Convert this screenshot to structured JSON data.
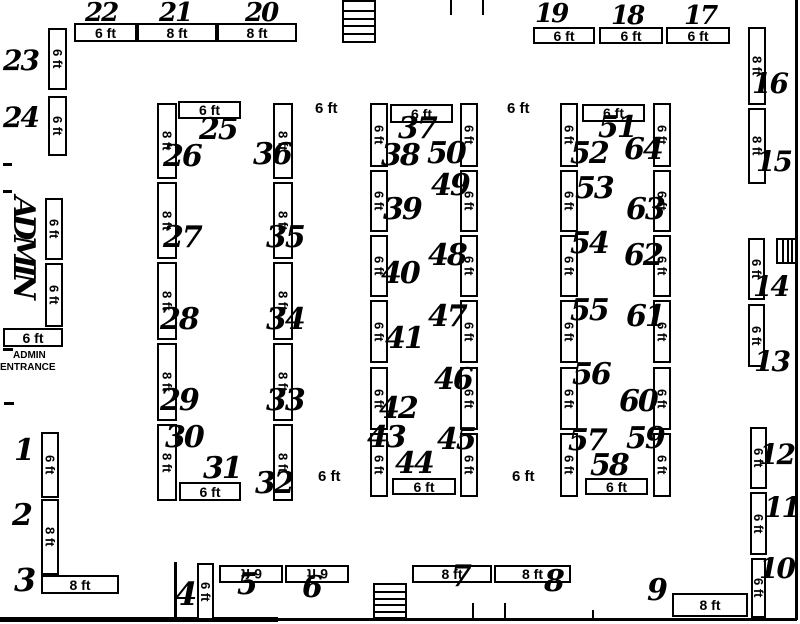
{
  "plan": {
    "colors": {
      "line": "#000000",
      "background": "#ffffff"
    },
    "admin": {
      "vertical_label": "ADMIN",
      "entrance_line1": "ADMIN",
      "entrance_line2": "ENTRANCE"
    },
    "floating_dims": [
      {
        "t": "6 ft",
        "x": 315,
        "y": 100
      },
      {
        "t": "6 ft",
        "x": 507,
        "y": 100
      },
      {
        "t": "6 ft",
        "x": 318,
        "y": 468
      },
      {
        "t": "6 ft",
        "x": 512,
        "y": 468
      }
    ],
    "dim_boxes": [
      {
        "t": "6 ft",
        "x": 74,
        "y": 23,
        "w": 63,
        "h": 19,
        "o": "h"
      },
      {
        "t": "8 ft",
        "x": 137,
        "y": 23,
        "w": 80,
        "h": 19,
        "o": "h"
      },
      {
        "t": "8 ft",
        "x": 217,
        "y": 23,
        "w": 80,
        "h": 19,
        "o": "h"
      },
      {
        "t": "6 ft",
        "x": 533,
        "y": 27,
        "w": 62,
        "h": 17,
        "o": "h"
      },
      {
        "t": "6 ft",
        "x": 599,
        "y": 27,
        "w": 64,
        "h": 17,
        "o": "h"
      },
      {
        "t": "6 ft",
        "x": 666,
        "y": 27,
        "w": 64,
        "h": 17,
        "o": "h"
      },
      {
        "t": "6 ft",
        "x": 48,
        "y": 28,
        "w": 19,
        "h": 62,
        "o": "v"
      },
      {
        "t": "6 ft",
        "x": 48,
        "y": 96,
        "w": 19,
        "h": 60,
        "o": "v"
      },
      {
        "t": "6 ft",
        "x": 45,
        "y": 198,
        "w": 18,
        "h": 62,
        "o": "v"
      },
      {
        "t": "6 ft",
        "x": 45,
        "y": 263,
        "w": 18,
        "h": 64,
        "o": "v"
      },
      {
        "t": "6 ft",
        "x": 3,
        "y": 328,
        "w": 60,
        "h": 19,
        "o": "h"
      },
      {
        "t": "6 ft",
        "x": 41,
        "y": 432,
        "w": 18,
        "h": 66,
        "o": "v"
      },
      {
        "t": "8 ft",
        "x": 41,
        "y": 499,
        "w": 18,
        "h": 76,
        "o": "v"
      },
      {
        "t": "8 ft",
        "x": 41,
        "y": 575,
        "w": 78,
        "h": 19,
        "o": "h"
      },
      {
        "t": "8 ft",
        "x": 748,
        "y": 27,
        "w": 18,
        "h": 78,
        "o": "v"
      },
      {
        "t": "8 ft",
        "x": 748,
        "y": 108,
        "w": 18,
        "h": 76,
        "o": "v"
      },
      {
        "t": "6 ft",
        "x": 748,
        "y": 238,
        "w": 17,
        "h": 62,
        "o": "v"
      },
      {
        "t": "6 ft",
        "x": 748,
        "y": 304,
        "w": 17,
        "h": 63,
        "o": "v"
      },
      {
        "t": "6 ft",
        "x": 750,
        "y": 427,
        "w": 17,
        "h": 62,
        "o": "v"
      },
      {
        "t": "6 ft",
        "x": 750,
        "y": 492,
        "w": 17,
        "h": 63,
        "o": "v"
      },
      {
        "t": "6 ft",
        "x": 751,
        "y": 558,
        "w": 15,
        "h": 60,
        "o": "v"
      },
      {
        "t": "8 ft",
        "x": 672,
        "y": 593,
        "w": 76,
        "h": 24,
        "o": "h"
      },
      {
        "t": "6 ft",
        "x": 197,
        "y": 563,
        "w": 17,
        "h": 57,
        "o": "v"
      },
      {
        "t": "6 ft",
        "x": 219,
        "y": 565,
        "w": 64,
        "h": 18,
        "o": "flip"
      },
      {
        "t": "6 ft",
        "x": 285,
        "y": 565,
        "w": 64,
        "h": 18,
        "o": "flip"
      },
      {
        "t": "8 ft",
        "x": 412,
        "y": 565,
        "w": 80,
        "h": 18,
        "o": "h"
      },
      {
        "t": "8 ft",
        "x": 494,
        "y": 565,
        "w": 77,
        "h": 18,
        "o": "h"
      },
      {
        "t": "6 ft",
        "x": 178,
        "y": 101,
        "w": 63,
        "h": 18,
        "o": "h"
      },
      {
        "t": "8 ft",
        "x": 157,
        "y": 103,
        "w": 20,
        "h": 76,
        "o": "v"
      },
      {
        "t": "8 ft",
        "x": 157,
        "y": 182,
        "w": 20,
        "h": 77,
        "o": "v"
      },
      {
        "t": "8 ft",
        "x": 157,
        "y": 262,
        "w": 20,
        "h": 78,
        "o": "v"
      },
      {
        "t": "8 ft",
        "x": 157,
        "y": 343,
        "w": 20,
        "h": 78,
        "o": "v"
      },
      {
        "t": "8 ft",
        "x": 157,
        "y": 424,
        "w": 20,
        "h": 77,
        "o": "v"
      },
      {
        "t": "8 ft",
        "x": 273,
        "y": 103,
        "w": 20,
        "h": 76,
        "o": "v"
      },
      {
        "t": "8 ft",
        "x": 273,
        "y": 182,
        "w": 20,
        "h": 77,
        "o": "v"
      },
      {
        "t": "8 ft",
        "x": 273,
        "y": 262,
        "w": 20,
        "h": 78,
        "o": "v"
      },
      {
        "t": "8 ft",
        "x": 273,
        "y": 343,
        "w": 20,
        "h": 78,
        "o": "v"
      },
      {
        "t": "8 ft",
        "x": 273,
        "y": 424,
        "w": 20,
        "h": 77,
        "o": "v"
      },
      {
        "t": "6 ft",
        "x": 179,
        "y": 482,
        "w": 62,
        "h": 19,
        "o": "h"
      },
      {
        "t": "6 ft",
        "x": 390,
        "y": 104,
        "w": 63,
        "h": 19,
        "o": "h"
      },
      {
        "t": "6 ft",
        "x": 370,
        "y": 103,
        "w": 18,
        "h": 64,
        "o": "v"
      },
      {
        "t": "6 ft",
        "x": 370,
        "y": 170,
        "w": 18,
        "h": 62,
        "o": "v"
      },
      {
        "t": "6 ft",
        "x": 370,
        "y": 235,
        "w": 18,
        "h": 62,
        "o": "v"
      },
      {
        "t": "6 ft",
        "x": 370,
        "y": 300,
        "w": 18,
        "h": 63,
        "o": "v"
      },
      {
        "t": "6 ft",
        "x": 370,
        "y": 367,
        "w": 18,
        "h": 63,
        "o": "v"
      },
      {
        "t": "6 ft",
        "x": 370,
        "y": 433,
        "w": 18,
        "h": 64,
        "o": "v"
      },
      {
        "t": "6 ft",
        "x": 460,
        "y": 103,
        "w": 18,
        "h": 64,
        "o": "v"
      },
      {
        "t": "6 ft",
        "x": 460,
        "y": 170,
        "w": 18,
        "h": 62,
        "o": "v"
      },
      {
        "t": "6 ft",
        "x": 460,
        "y": 235,
        "w": 18,
        "h": 62,
        "o": "v"
      },
      {
        "t": "6 ft",
        "x": 460,
        "y": 300,
        "w": 18,
        "h": 63,
        "o": "v"
      },
      {
        "t": "6 ft",
        "x": 460,
        "y": 367,
        "w": 18,
        "h": 63,
        "o": "v"
      },
      {
        "t": "6 ft",
        "x": 460,
        "y": 433,
        "w": 18,
        "h": 64,
        "o": "v"
      },
      {
        "t": "6 ft",
        "x": 392,
        "y": 478,
        "w": 64,
        "h": 17,
        "o": "h"
      },
      {
        "t": "6 ft",
        "x": 582,
        "y": 104,
        "w": 63,
        "h": 18,
        "o": "h"
      },
      {
        "t": "6 ft",
        "x": 560,
        "y": 103,
        "w": 18,
        "h": 64,
        "o": "v"
      },
      {
        "t": "6 ft",
        "x": 560,
        "y": 170,
        "w": 18,
        "h": 62,
        "o": "v"
      },
      {
        "t": "6 ft",
        "x": 560,
        "y": 235,
        "w": 18,
        "h": 62,
        "o": "v"
      },
      {
        "t": "6 ft",
        "x": 560,
        "y": 300,
        "w": 18,
        "h": 63,
        "o": "v"
      },
      {
        "t": "6 ft",
        "x": 560,
        "y": 367,
        "w": 18,
        "h": 63,
        "o": "v"
      },
      {
        "t": "6 ft",
        "x": 560,
        "y": 433,
        "w": 18,
        "h": 64,
        "o": "v"
      },
      {
        "t": "6 ft",
        "x": 653,
        "y": 103,
        "w": 18,
        "h": 64,
        "o": "v"
      },
      {
        "t": "6 ft",
        "x": 653,
        "y": 170,
        "w": 18,
        "h": 62,
        "o": "v"
      },
      {
        "t": "6 ft",
        "x": 653,
        "y": 235,
        "w": 18,
        "h": 62,
        "o": "v"
      },
      {
        "t": "6 ft",
        "x": 653,
        "y": 300,
        "w": 18,
        "h": 63,
        "o": "v"
      },
      {
        "t": "6 ft",
        "x": 653,
        "y": 367,
        "w": 18,
        "h": 63,
        "o": "v"
      },
      {
        "t": "6 ft",
        "x": 653,
        "y": 433,
        "w": 18,
        "h": 64,
        "o": "v"
      },
      {
        "t": "6 ft",
        "x": 585,
        "y": 478,
        "w": 63,
        "h": 17,
        "o": "h"
      }
    ],
    "booth_numbers": [
      {
        "n": "1",
        "x": 14,
        "y": 436,
        "s": 30
      },
      {
        "n": "2",
        "x": 12,
        "y": 501,
        "s": 30
      },
      {
        "n": "3",
        "x": 14,
        "y": 564,
        "s": 32
      },
      {
        "n": "4",
        "x": 175,
        "y": 578,
        "s": 32
      },
      {
        "n": "5",
        "x": 237,
        "y": 570,
        "s": 30
      },
      {
        "n": "6",
        "x": 302,
        "y": 573,
        "s": 30
      },
      {
        "n": "7",
        "x": 451,
        "y": 562,
        "s": 30
      },
      {
        "n": "8",
        "x": 544,
        "y": 567,
        "s": 30
      },
      {
        "n": "9",
        "x": 647,
        "y": 576,
        "s": 30
      },
      {
        "n": "10",
        "x": 759,
        "y": 555,
        "s": 28
      },
      {
        "n": "11",
        "x": 764,
        "y": 494,
        "s": 28
      },
      {
        "n": "12",
        "x": 759,
        "y": 441,
        "s": 28
      },
      {
        "n": "13",
        "x": 754,
        "y": 348,
        "s": 28
      },
      {
        "n": "14",
        "x": 753,
        "y": 273,
        "s": 28
      },
      {
        "n": "15",
        "x": 756,
        "y": 148,
        "s": 28
      },
      {
        "n": "16",
        "x": 752,
        "y": 70,
        "s": 28
      },
      {
        "n": "17",
        "x": 684,
        "y": 3,
        "s": 26
      },
      {
        "n": "18",
        "x": 611,
        "y": 3,
        "s": 26
      },
      {
        "n": "19",
        "x": 535,
        "y": 1,
        "s": 26
      },
      {
        "n": "20",
        "x": 245,
        "y": 0,
        "s": 26
      },
      {
        "n": "21",
        "x": 159,
        "y": 0,
        "s": 26
      },
      {
        "n": "22",
        "x": 85,
        "y": 0,
        "s": 26
      },
      {
        "n": "23",
        "x": 3,
        "y": 47,
        "s": 28
      },
      {
        "n": "24",
        "x": 3,
        "y": 104,
        "s": 28
      },
      {
        "n": "25",
        "x": 199,
        "y": 115,
        "s": 30
      },
      {
        "n": "26",
        "x": 163,
        "y": 142,
        "s": 30
      },
      {
        "n": "27",
        "x": 163,
        "y": 223,
        "s": 30
      },
      {
        "n": "28",
        "x": 160,
        "y": 305,
        "s": 30
      },
      {
        "n": "29",
        "x": 160,
        "y": 386,
        "s": 30
      },
      {
        "n": "30",
        "x": 165,
        "y": 423,
        "s": 30
      },
      {
        "n": "31",
        "x": 203,
        "y": 454,
        "s": 30
      },
      {
        "n": "32",
        "x": 255,
        "y": 469,
        "s": 30
      },
      {
        "n": "33",
        "x": 266,
        "y": 386,
        "s": 30
      },
      {
        "n": "34",
        "x": 266,
        "y": 305,
        "s": 30
      },
      {
        "n": "35",
        "x": 266,
        "y": 223,
        "s": 30
      },
      {
        "n": "36",
        "x": 253,
        "y": 140,
        "s": 30
      },
      {
        "n": "37",
        "x": 398,
        "y": 114,
        "s": 30
      },
      {
        "n": "38",
        "x": 381,
        "y": 141,
        "s": 30
      },
      {
        "n": "39",
        "x": 383,
        "y": 195,
        "s": 30
      },
      {
        "n": "40",
        "x": 381,
        "y": 259,
        "s": 30
      },
      {
        "n": "41",
        "x": 385,
        "y": 324,
        "s": 30
      },
      {
        "n": "42",
        "x": 379,
        "y": 394,
        "s": 30
      },
      {
        "n": "43",
        "x": 367,
        "y": 423,
        "s": 30
      },
      {
        "n": "44",
        "x": 395,
        "y": 449,
        "s": 30
      },
      {
        "n": "45",
        "x": 437,
        "y": 425,
        "s": 30
      },
      {
        "n": "46",
        "x": 434,
        "y": 365,
        "s": 30
      },
      {
        "n": "47",
        "x": 428,
        "y": 302,
        "s": 30
      },
      {
        "n": "48",
        "x": 428,
        "y": 241,
        "s": 30
      },
      {
        "n": "49",
        "x": 431,
        "y": 171,
        "s": 30
      },
      {
        "n": "50",
        "x": 427,
        "y": 139,
        "s": 30
      },
      {
        "n": "51",
        "x": 598,
        "y": 113,
        "s": 30
      },
      {
        "n": "52",
        "x": 570,
        "y": 139,
        "s": 30
      },
      {
        "n": "53",
        "x": 575,
        "y": 174,
        "s": 30
      },
      {
        "n": "54",
        "x": 570,
        "y": 229,
        "s": 30
      },
      {
        "n": "55",
        "x": 570,
        "y": 296,
        "s": 30
      },
      {
        "n": "56",
        "x": 572,
        "y": 360,
        "s": 30
      },
      {
        "n": "57",
        "x": 568,
        "y": 426,
        "s": 30
      },
      {
        "n": "58",
        "x": 590,
        "y": 451,
        "s": 30
      },
      {
        "n": "59",
        "x": 626,
        "y": 424,
        "s": 30
      },
      {
        "n": "60",
        "x": 619,
        "y": 387,
        "s": 30
      },
      {
        "n": "61",
        "x": 626,
        "y": 302,
        "s": 30
      },
      {
        "n": "62",
        "x": 624,
        "y": 241,
        "s": 30
      },
      {
        "n": "63",
        "x": 626,
        "y": 195,
        "s": 30
      },
      {
        "n": "64",
        "x": 624,
        "y": 135,
        "s": 30
      }
    ],
    "stairs": [
      {
        "x": 342,
        "y": 0,
        "w": 34,
        "h": 43,
        "dir": "h",
        "steps": 4
      },
      {
        "x": 373,
        "y": 583,
        "w": 34,
        "h": 36,
        "dir": "h",
        "steps": 4
      },
      {
        "x": 776,
        "y": 238,
        "w": 21,
        "h": 26,
        "dir": "v",
        "steps": 3
      }
    ],
    "walls": [
      {
        "x": 0,
        "y": 617,
        "w": 278,
        "h": 5
      },
      {
        "x": 278,
        "y": 618,
        "w": 519,
        "h": 3
      },
      {
        "x": 795,
        "y": 0,
        "w": 3,
        "h": 620
      },
      {
        "x": 450,
        "y": 0,
        "w": 2,
        "h": 15
      },
      {
        "x": 482,
        "y": 0,
        "w": 2,
        "h": 15
      },
      {
        "x": 3,
        "y": 163,
        "w": 9,
        "h": 3
      },
      {
        "x": 3,
        "y": 190,
        "w": 9,
        "h": 3
      },
      {
        "x": 3,
        "y": 348,
        "w": 10,
        "h": 3
      },
      {
        "x": 4,
        "y": 402,
        "w": 10,
        "h": 3
      },
      {
        "x": 174,
        "y": 562,
        "w": 3,
        "h": 56
      },
      {
        "x": 472,
        "y": 603,
        "w": 2,
        "h": 15
      },
      {
        "x": 504,
        "y": 603,
        "w": 2,
        "h": 15
      },
      {
        "x": 592,
        "y": 610,
        "w": 2,
        "h": 8
      }
    ]
  }
}
